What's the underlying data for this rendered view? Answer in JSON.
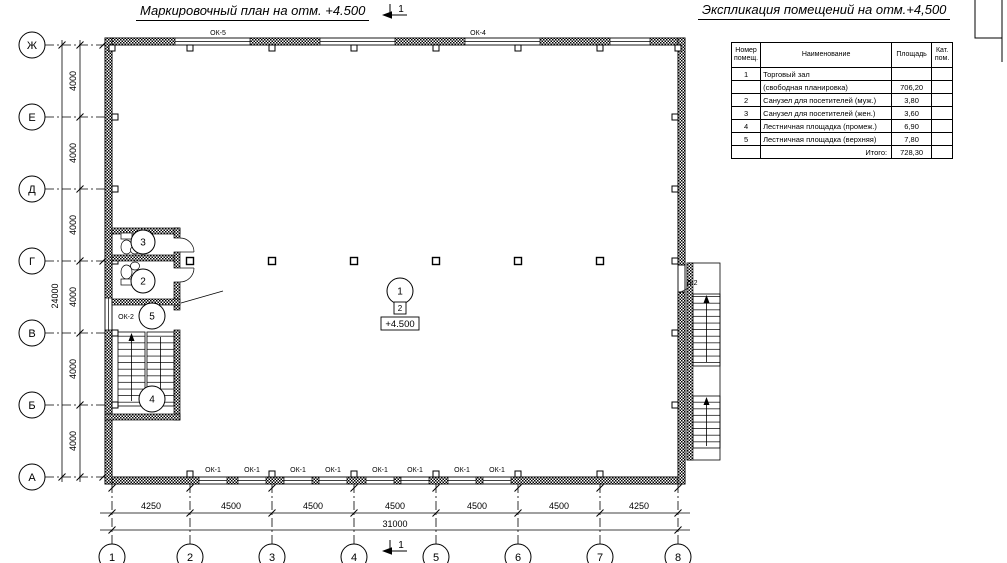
{
  "titles": {
    "plan": "Маркировочный план на отм. +4.500",
    "schedule": "Экспликация помещений на отм.+4,500"
  },
  "section_mark": {
    "label": "1"
  },
  "schedule_table": {
    "headers": [
      "Номер помещ.",
      "Наименование",
      "Площадь",
      "Кат. пом."
    ],
    "rows": [
      [
        "1",
        "Торговый зал",
        "",
        ""
      ],
      [
        "",
        "(свободная планировка)",
        "706,20",
        ""
      ],
      [
        "2",
        "Санузел для посетителей (муж.)",
        "3,80",
        ""
      ],
      [
        "3",
        "Санузел для посетителей (жен.)",
        "3,60",
        ""
      ],
      [
        "4",
        "Лестничная площадка (промеж.)",
        "6,90",
        ""
      ],
      [
        "5",
        "Лестничная площадка (верхняя)",
        "7,80",
        ""
      ],
      [
        "",
        "Итого:",
        "728,30",
        ""
      ]
    ]
  },
  "axes": {
    "rows": [
      "Ж",
      "Е",
      "Д",
      "Г",
      "В",
      "Б",
      "А"
    ],
    "cols": [
      "1",
      "2",
      "3",
      "4",
      "5",
      "6",
      "7",
      "8"
    ]
  },
  "dimensions": {
    "vertical_segments": [
      "4000",
      "4000",
      "4000",
      "4000",
      "4000",
      "4000"
    ],
    "vertical_total": "24000",
    "horizontal_segments": [
      "4250",
      "4500",
      "4500",
      "4500",
      "4500",
      "4500",
      "4250"
    ],
    "horizontal_total": "31000"
  },
  "windows": {
    "top": [
      "ОК-5",
      "ОК-4"
    ],
    "bottom": [
      "ОК-1",
      "ОК-1",
      "ОК-1",
      "ОК-1",
      "ОК-1",
      "ОК-1",
      "ОК-1",
      "ОК-1"
    ],
    "left": "ОК-2"
  },
  "door": {
    "label": "Д-2"
  },
  "rooms": {
    "hall": "1",
    "wc_men": "2",
    "wc_women": "3",
    "stair_mid": "4",
    "stair_upper": "5"
  },
  "markers": {
    "floor_type": "2",
    "elevation": "+4.500"
  }
}
